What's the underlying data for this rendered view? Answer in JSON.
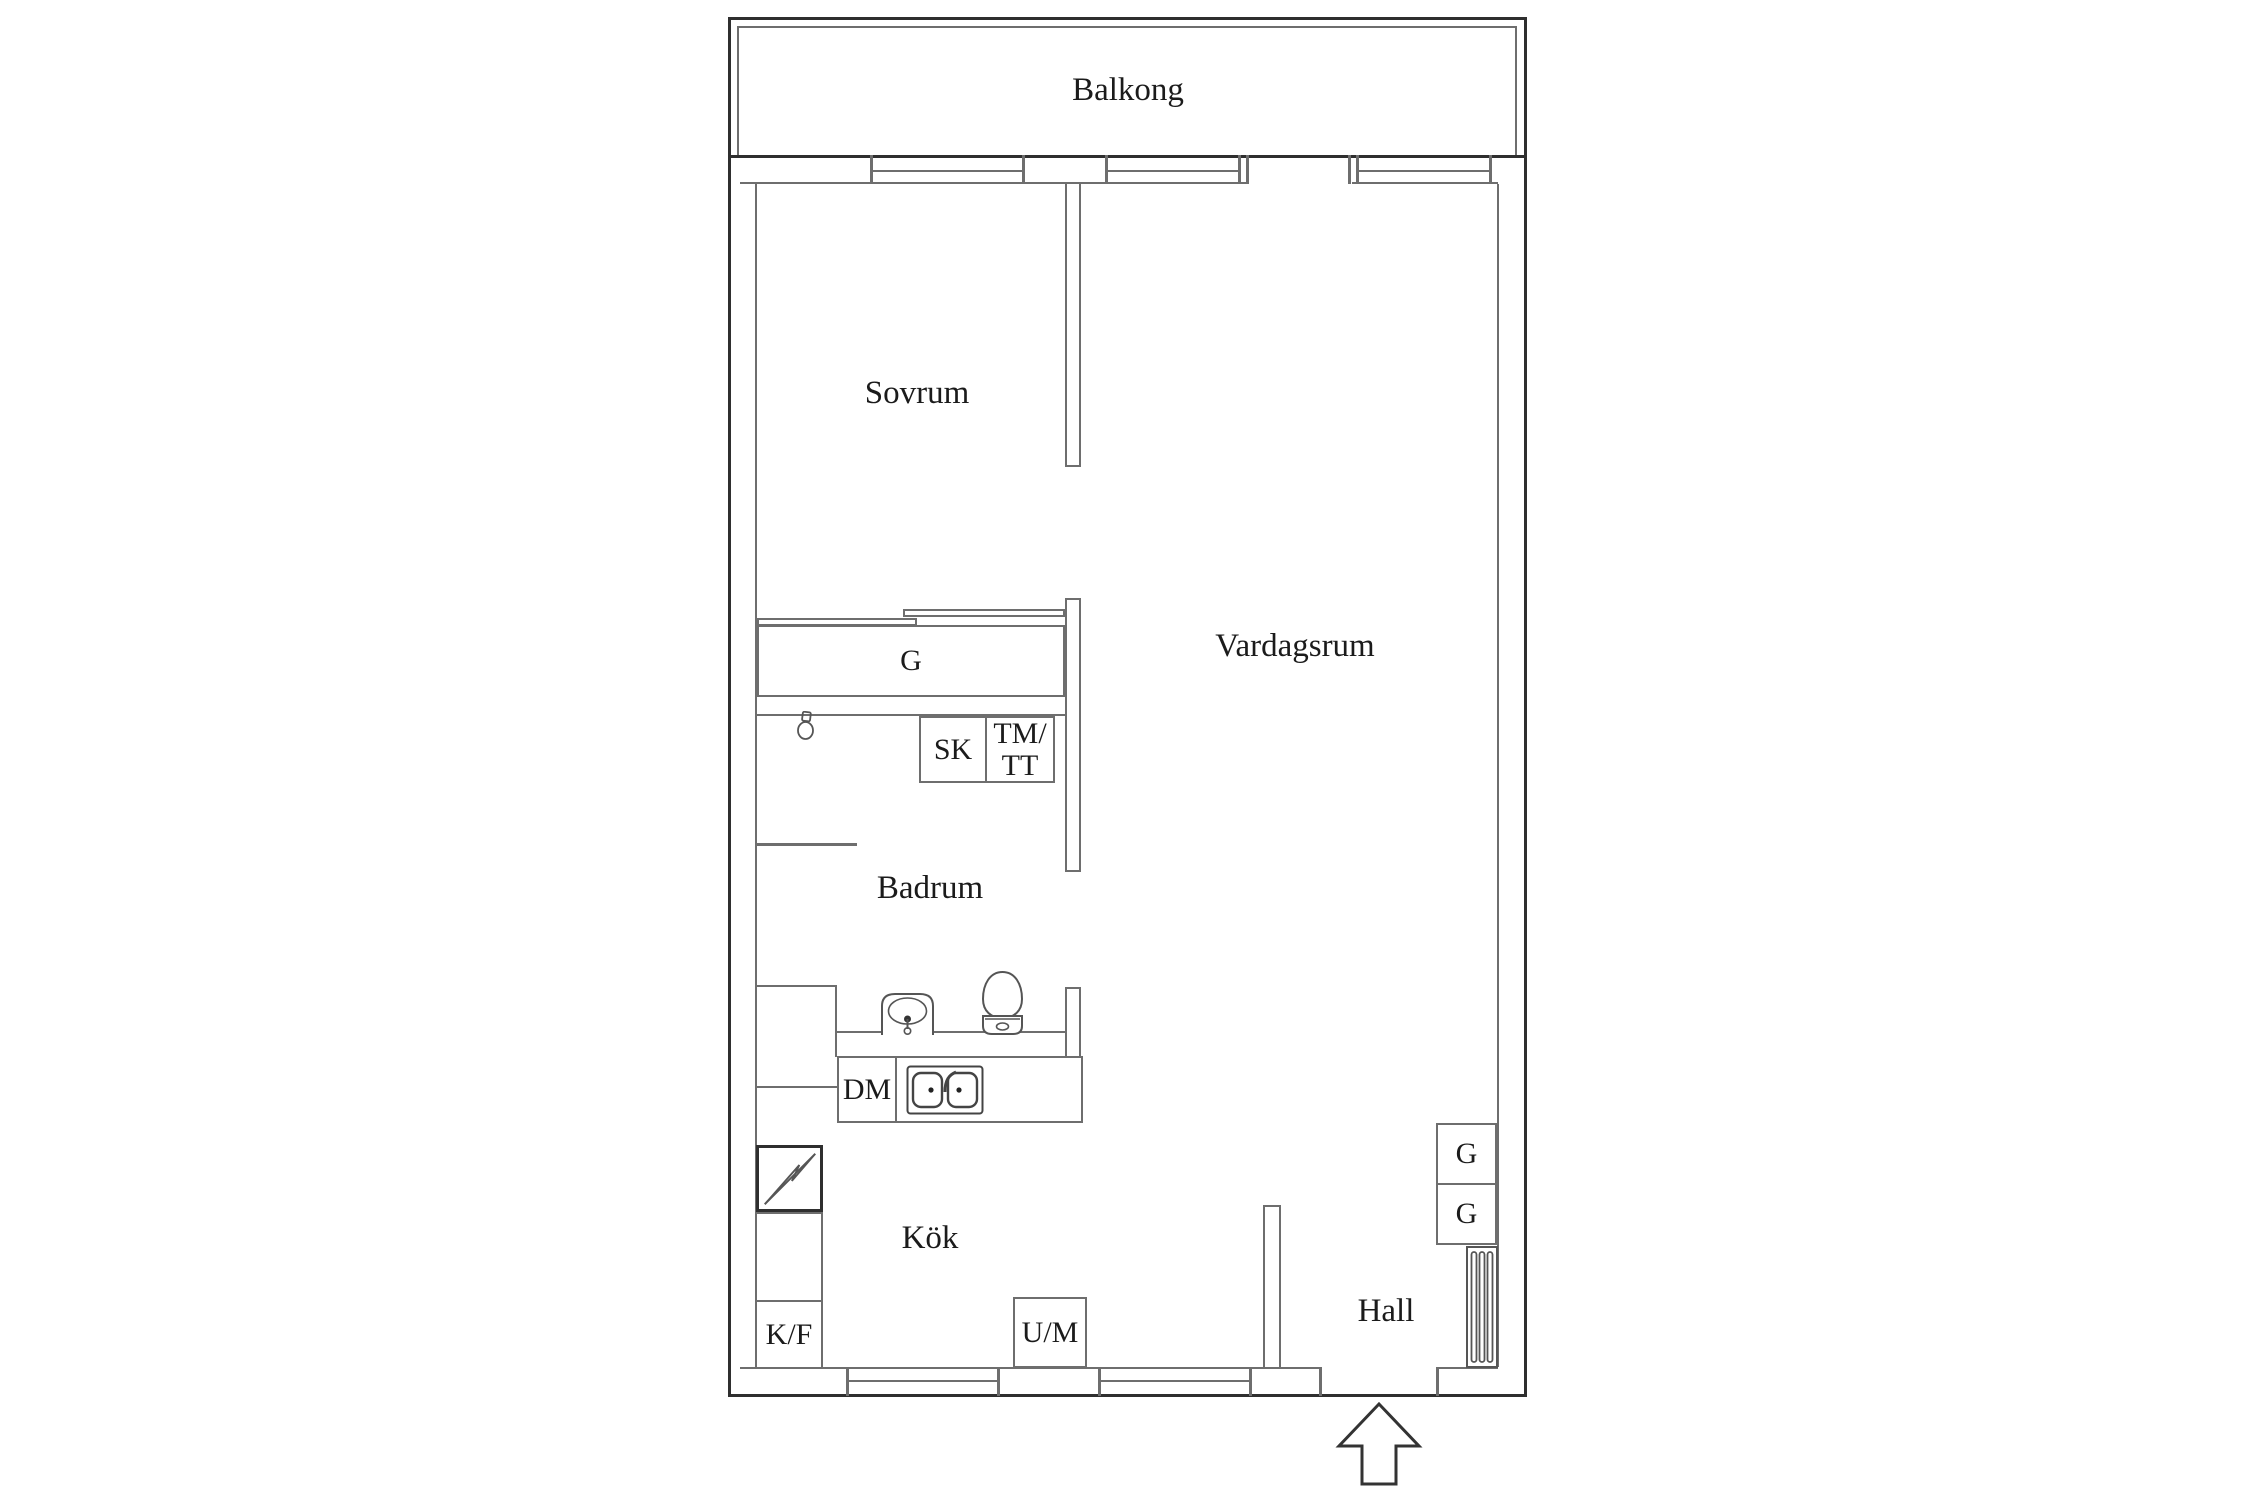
{
  "rooms": {
    "balcony": "Balkong",
    "bedroom": "Sovrum",
    "living_room": "Vardagsrum",
    "bathroom": "Badrum",
    "kitchen": "Kök",
    "hall": "Hall"
  },
  "fixtures": {
    "bedroom_wardrobe": "G",
    "cleaning_cabinet": "SK",
    "washer_dryer_line1": "TM/",
    "washer_dryer_line2": "TT",
    "dishwasher": "DM",
    "fridge_freezer": "K/F",
    "oven_microwave": "U/M",
    "hall_wardrobe_1": "G",
    "hall_wardrobe_2": "G"
  },
  "icons": {
    "ceiling_lamp": "pendant-lamp",
    "bathroom_sink": "washbasin",
    "toilet": "wc",
    "kitchen_sink": "double-bowl-sink",
    "electrical_panel": "lightning-bolt",
    "radiator": "striped-panel",
    "entry_arrow": "up-arrow"
  },
  "colors": {
    "wall_outer": "#2f2f2f",
    "wall_inner": "#6e6e6e",
    "text": "#1b1b1b",
    "background": "#ffffff"
  }
}
